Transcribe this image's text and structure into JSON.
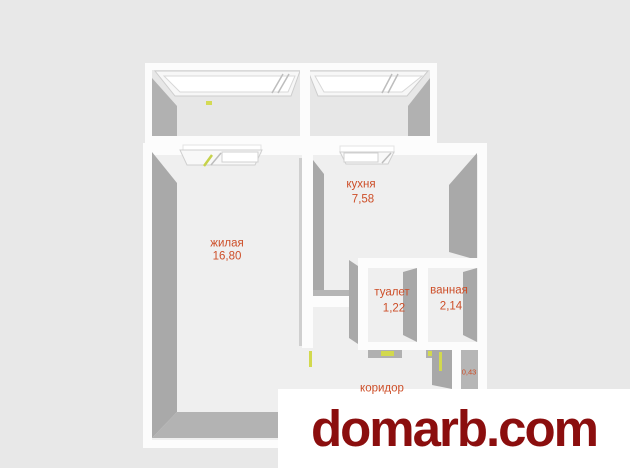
{
  "colors": {
    "background": "#e8e8e8",
    "wall_white": "#fcfcfc",
    "wall_face_gray": "#a9a9a9",
    "floor": "#efefef",
    "room_label": "#cd4e28",
    "door_marker_yellow": "#d2d94e",
    "watermark_red": "#8b0e0e"
  },
  "floor_plan": {
    "rooms": [
      {
        "name": "жилая",
        "area": "16,80"
      },
      {
        "name": "кухня",
        "area": "7,58"
      },
      {
        "name": "туалет",
        "area": "1,22"
      },
      {
        "name": "ванная",
        "area": "2,14"
      },
      {
        "name": "коридор",
        "area": ""
      },
      {
        "name": "",
        "area": "0,43"
      }
    ]
  },
  "watermark": {
    "text": "domarb.com"
  }
}
